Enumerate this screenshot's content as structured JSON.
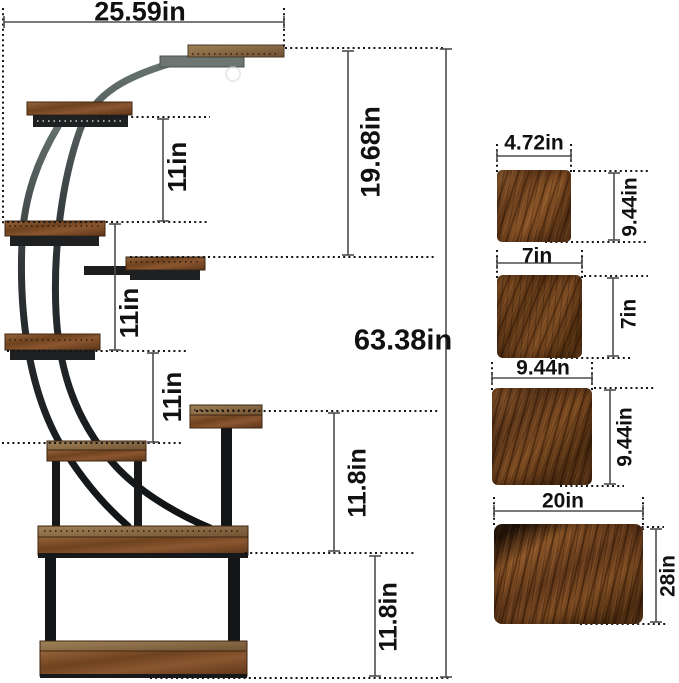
{
  "colors": {
    "text": "#111111",
    "dim-line": "#4d4d4d",
    "dot-line": "#161616",
    "wood": "#7c4a22",
    "metal": "#1c1e20",
    "metal-gray": "#6e7674",
    "bg": "#ffffff"
  },
  "stand": {
    "overall_width": "25.59in",
    "overall_height": "63.38in",
    "top_drop": "19.68in",
    "tier_gaps": [
      "11in",
      "11in",
      "11in"
    ],
    "base_gaps": [
      "11.8in",
      "11.8in"
    ]
  },
  "boards": [
    {
      "id": "board-4x9",
      "width": "4.72in",
      "height": "9.44in"
    },
    {
      "id": "board-7x7",
      "width": "7in",
      "height": "7in"
    },
    {
      "id": "board-9x9",
      "width": "9.44n",
      "height": "9.44in"
    },
    {
      "id": "board-20x28",
      "width": "20in",
      "height": "28in"
    }
  ]
}
